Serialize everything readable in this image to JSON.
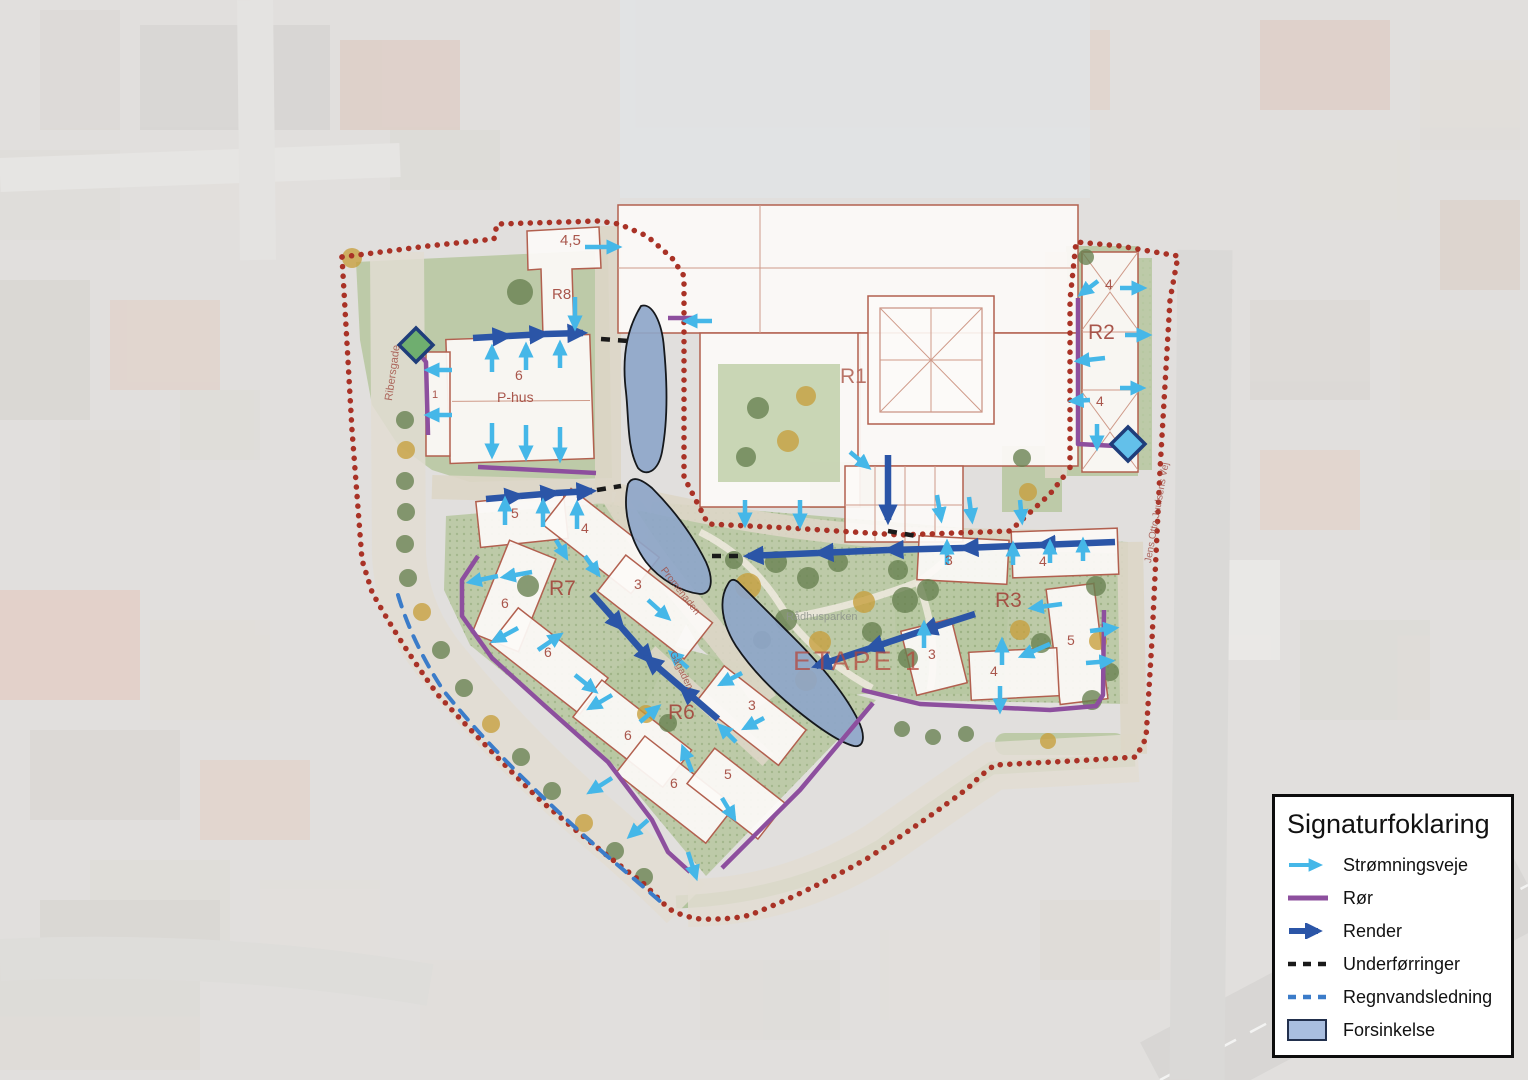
{
  "legend": {
    "title": "Signaturfoklaring",
    "items": [
      {
        "label": "Strømningsveje",
        "symbol": "light-blue-arrow",
        "color": "#45b7e8"
      },
      {
        "label": "Rør",
        "symbol": "purple-line",
        "color": "#8d4f9e"
      },
      {
        "label": "Render",
        "symbol": "dark-blue-arrow",
        "color": "#2b55a7"
      },
      {
        "label": "Underførringer",
        "symbol": "black-dashed-line",
        "color": "#1a1a1a"
      },
      {
        "label": "Regnvandsledning",
        "symbol": "blue-dashed-line",
        "color": "#3b7cc9"
      },
      {
        "label": "Forsinkelse",
        "symbol": "filled-rectangle",
        "color": "#a9bedf"
      }
    ]
  },
  "map": {
    "labels": [
      {
        "text": "4,5",
        "x": 560,
        "y": 233,
        "size": 15,
        "color": "#a3493e"
      },
      {
        "text": "R8",
        "x": 552,
        "y": 287,
        "size": 15,
        "color": "#a3493e"
      },
      {
        "text": "6",
        "x": 515,
        "y": 368,
        "size": 14,
        "color": "#a3493e"
      },
      {
        "text": "P-hus",
        "x": 497,
        "y": 390,
        "size": 14,
        "color": "#a3493e"
      },
      {
        "text": "1",
        "x": 432,
        "y": 390,
        "size": 11,
        "color": "#a3493e"
      },
      {
        "text": "R1",
        "x": 840,
        "y": 366,
        "size": 21,
        "color": "#b4695c"
      },
      {
        "text": "4",
        "x": 1105,
        "y": 277,
        "size": 14,
        "color": "#a3493e"
      },
      {
        "text": "R2",
        "x": 1088,
        "y": 322,
        "size": 21,
        "color": "#a3493e"
      },
      {
        "text": "4",
        "x": 1096,
        "y": 394,
        "size": 14,
        "color": "#a3493e"
      },
      {
        "text": "5",
        "x": 511,
        "y": 506,
        "size": 14,
        "color": "#a3493e"
      },
      {
        "text": "4",
        "x": 581,
        "y": 521,
        "size": 14,
        "color": "#a3493e"
      },
      {
        "text": "3",
        "x": 634,
        "y": 577,
        "size": 14,
        "color": "#a3493e"
      },
      {
        "text": "R7",
        "x": 549,
        "y": 578,
        "size": 21,
        "color": "#a3493e"
      },
      {
        "text": "6",
        "x": 501,
        "y": 596,
        "size": 14,
        "color": "#a3493e"
      },
      {
        "text": "6",
        "x": 544,
        "y": 645,
        "size": 14,
        "color": "#a3493e"
      },
      {
        "text": "3",
        "x": 748,
        "y": 698,
        "size": 14,
        "color": "#a3493e"
      },
      {
        "text": "R6",
        "x": 668,
        "y": 702,
        "size": 21,
        "color": "#a3493e"
      },
      {
        "text": "6",
        "x": 624,
        "y": 728,
        "size": 14,
        "color": "#a3493e"
      },
      {
        "text": "6",
        "x": 670,
        "y": 776,
        "size": 14,
        "color": "#a3493e"
      },
      {
        "text": "5",
        "x": 724,
        "y": 767,
        "size": 14,
        "color": "#a3493e"
      },
      {
        "text": "3",
        "x": 945,
        "y": 553,
        "size": 14,
        "color": "#a3493e"
      },
      {
        "text": "4",
        "x": 1039,
        "y": 554,
        "size": 14,
        "color": "#a3493e"
      },
      {
        "text": "R3",
        "x": 995,
        "y": 590,
        "size": 21,
        "color": "#a3493e"
      },
      {
        "text": "3",
        "x": 928,
        "y": 647,
        "size": 14,
        "color": "#a3493e"
      },
      {
        "text": "4",
        "x": 990,
        "y": 664,
        "size": 14,
        "color": "#a3493e"
      },
      {
        "text": "5",
        "x": 1067,
        "y": 633,
        "size": 14,
        "color": "#a3493e"
      },
      {
        "text": "ETAPE 1",
        "x": 793,
        "y": 648,
        "size": 27,
        "color": "#b5453a",
        "op": 0.72,
        "ls": 3
      },
      {
        "text": "Rådhusparken",
        "x": 786,
        "y": 612,
        "size": 11,
        "color": "#8e948c",
        "op": 0.85
      },
      {
        "text": "Ribersgade",
        "x": 384,
        "y": 400,
        "size": 11,
        "color": "#a04a40",
        "rot": -82,
        "op": 0.8
      },
      {
        "text": "Jens Otto Juulsens Vej",
        "x": 1144,
        "y": 562,
        "size": 10,
        "color": "#a04a40",
        "rot": -80,
        "op": 0.8
      },
      {
        "text": "Promenaden",
        "x": 666,
        "y": 566,
        "size": 10,
        "color": "#a04a40",
        "rot": 52,
        "op": 0.8
      },
      {
        "text": "Gågaden",
        "x": 676,
        "y": 650,
        "size": 10,
        "color": "#a04a40",
        "rot": 64,
        "op": 0.8
      }
    ]
  }
}
